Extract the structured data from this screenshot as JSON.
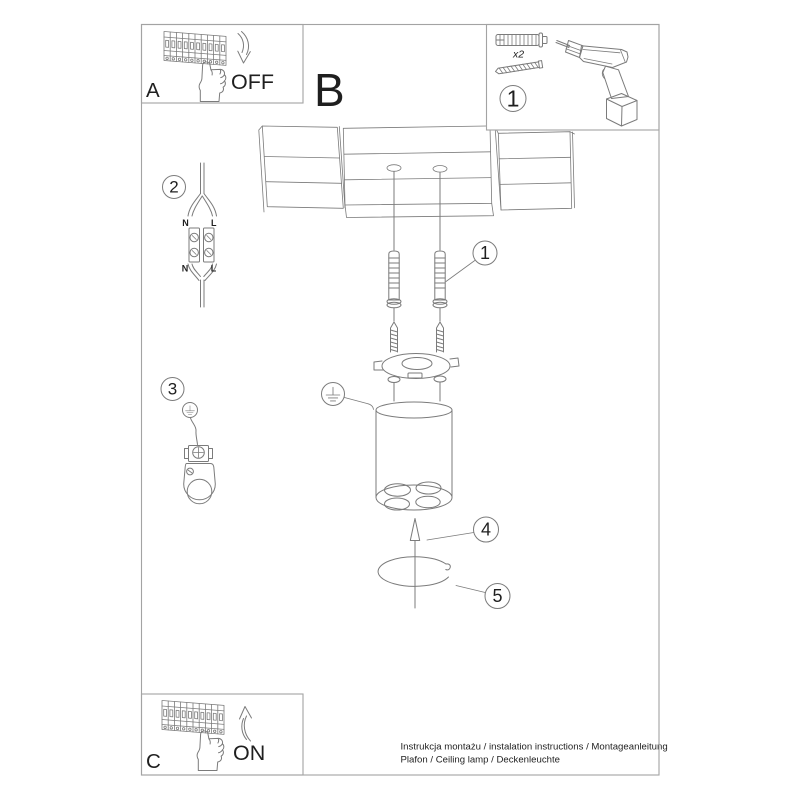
{
  "colors": {
    "line": "#7b7b7b",
    "text": "#1f1f1f",
    "border": "#a3a3a3",
    "background": "#ffffff"
  },
  "sheet": {
    "step_a": {
      "label": "A",
      "action": "OFF"
    },
    "step_b": {
      "label": "B"
    },
    "step_c": {
      "label": "C",
      "action": "ON"
    },
    "tools_box": {
      "number": "1",
      "quantity_label": "x2"
    },
    "callouts": {
      "step1": "1",
      "step2": "2",
      "step3": "3",
      "step4": "4",
      "step5": "5"
    },
    "wiring_labels": {
      "neutral_top": "N",
      "live_top": "L",
      "neutral_bottom": "N",
      "live_bottom": "L"
    },
    "footer": {
      "line1": "Instrukcja montażu / instalation instructions / Montageanleitung",
      "line2": "Plafon / Ceiling lamp / Deckenleuchte"
    }
  }
}
